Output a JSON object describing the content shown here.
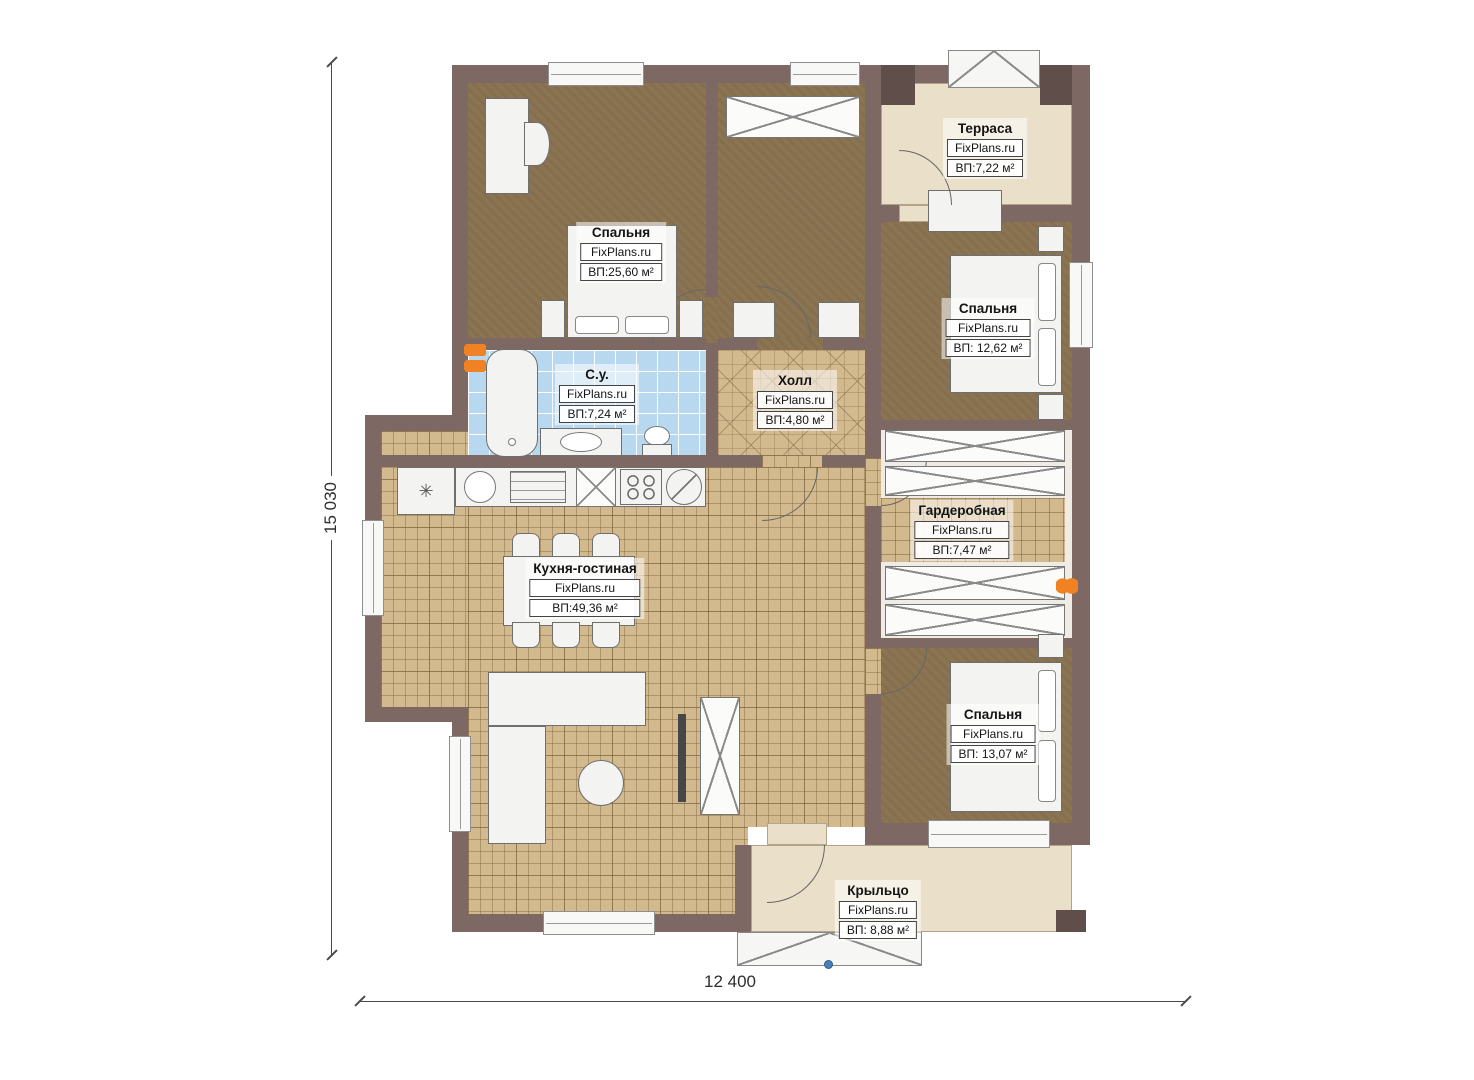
{
  "plan_title": "Floor plan",
  "watermark": "FixPlans.ru",
  "dimensions": {
    "height_total": "15 030",
    "width_total": "12 400"
  },
  "rooms": [
    {
      "id": "bedroom-1",
      "name": "Спальня",
      "brand": "FixPlans.ru",
      "area": "ВП:25,60 м²"
    },
    {
      "id": "terrace",
      "name": "Терраса",
      "brand": "FixPlans.ru",
      "area": "ВП:7,22 м²"
    },
    {
      "id": "bedroom-2",
      "name": "Спальня",
      "brand": "FixPlans.ru",
      "area": "ВП: 12,62 м²"
    },
    {
      "id": "bathroom",
      "name": "С.у.",
      "brand": "FixPlans.ru",
      "area": "ВП:7,24 м²"
    },
    {
      "id": "hall",
      "name": "Холл",
      "brand": "FixPlans.ru",
      "area": "ВП:4,80 м²"
    },
    {
      "id": "wardrobe-room",
      "name": "Гардеробная",
      "brand": "FixPlans.ru",
      "area": "ВП:7,47 м²"
    },
    {
      "id": "kitchen-living",
      "name": "Кухня-гостиная",
      "brand": "FixPlans.ru",
      "area": "ВП:49,36 м²"
    },
    {
      "id": "bedroom-3",
      "name": "Спальня",
      "brand": "FixPlans.ru",
      "area": "ВП: 13,07 м²"
    },
    {
      "id": "porch",
      "name": "Крыльцо",
      "brand": "FixPlans.ru",
      "area": "ВП: 8,88 м²"
    }
  ],
  "colors": {
    "wall": "#7d6864",
    "wall_dark": "#5f4e4a",
    "floor_bedroom": "#8b7452",
    "floor_tile": "#d3b98e",
    "floor_bath": "#b7d8ee",
    "floor_outdoor": "#eadfc8",
    "furniture": "#f3f3f1",
    "radiator_accent": "#f08223",
    "step_marker": "#4a7fb5"
  }
}
